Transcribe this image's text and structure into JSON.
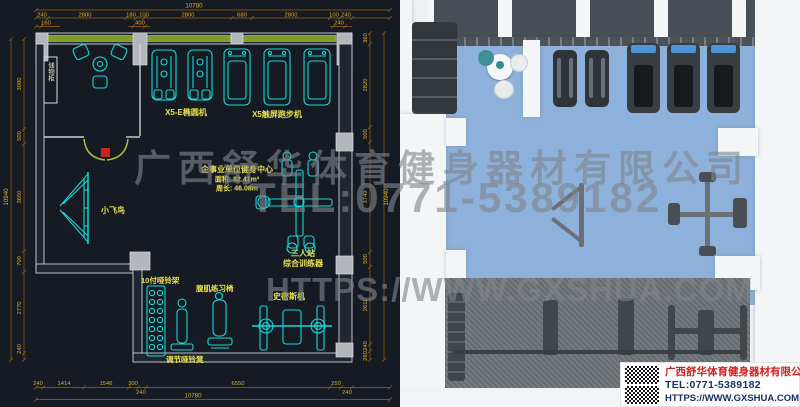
{
  "watermark": {
    "line1": "广西舒华体育健身器材有限公司",
    "line2": "TEL:0771-5389182",
    "line3": "HTTPS://WWW.GXSHUA.COM"
  },
  "footer_card": {
    "company": "广西舒华体育健身器材有限公司",
    "tel": "TEL:0771-5389182",
    "url": "HTTPS://WWW.GXSHUA.COM"
  },
  "plan": {
    "room_info": {
      "title": "企事业单位健身中心",
      "area": "面积: 82.41m²",
      "perimeter": "周长: 46.08m"
    },
    "labels": {
      "storage": "储物柜",
      "elliptical": "X5-E椭圆机",
      "treadmill": "X5触屏跑步机",
      "fly_bird": "小飞鸟",
      "station_line1": "三人站",
      "station_line2": "综合训练器",
      "dumbbell_rack": "10付哑铃架",
      "ab_bench": "腹肌练习椅",
      "smith": "史密斯机",
      "adj_bench": "调节哑铃凳"
    },
    "dims": {
      "top_total": "10780",
      "top_row": [
        "240",
        "2800",
        "180",
        "100",
        "2800",
        "680",
        "2800",
        "100",
        "240"
      ],
      "top_sub": [
        "160",
        "400",
        "240"
      ],
      "bottom_row": [
        "240",
        "1414",
        "1546",
        "300",
        "6550",
        "250"
      ],
      "bottom_sub": [
        "240",
        "240"
      ],
      "bottom_total": "10780",
      "left_col": [
        "3080",
        "500",
        "3650",
        "700",
        "2770",
        "240"
      ],
      "left_total": "10940",
      "right_col": [
        "360",
        "2820",
        "500",
        "3749",
        "500",
        "2611",
        "240",
        "260"
      ],
      "right_total": "10940"
    }
  },
  "colors": {
    "cad_background": "#151a23",
    "cad_equipment_cyan": "#12dbdb",
    "cad_dim_orange": "#a06018",
    "cad_dim_text": "#d8b124",
    "cad_label_yellow": "#e9e24e",
    "cad_window_green": "#7e9d28",
    "render_floor_blue": "#8db1da",
    "render_mat_gray": "#6f7478",
    "card_company_red": "#d21f1f",
    "card_contact_navy": "#16306b"
  }
}
